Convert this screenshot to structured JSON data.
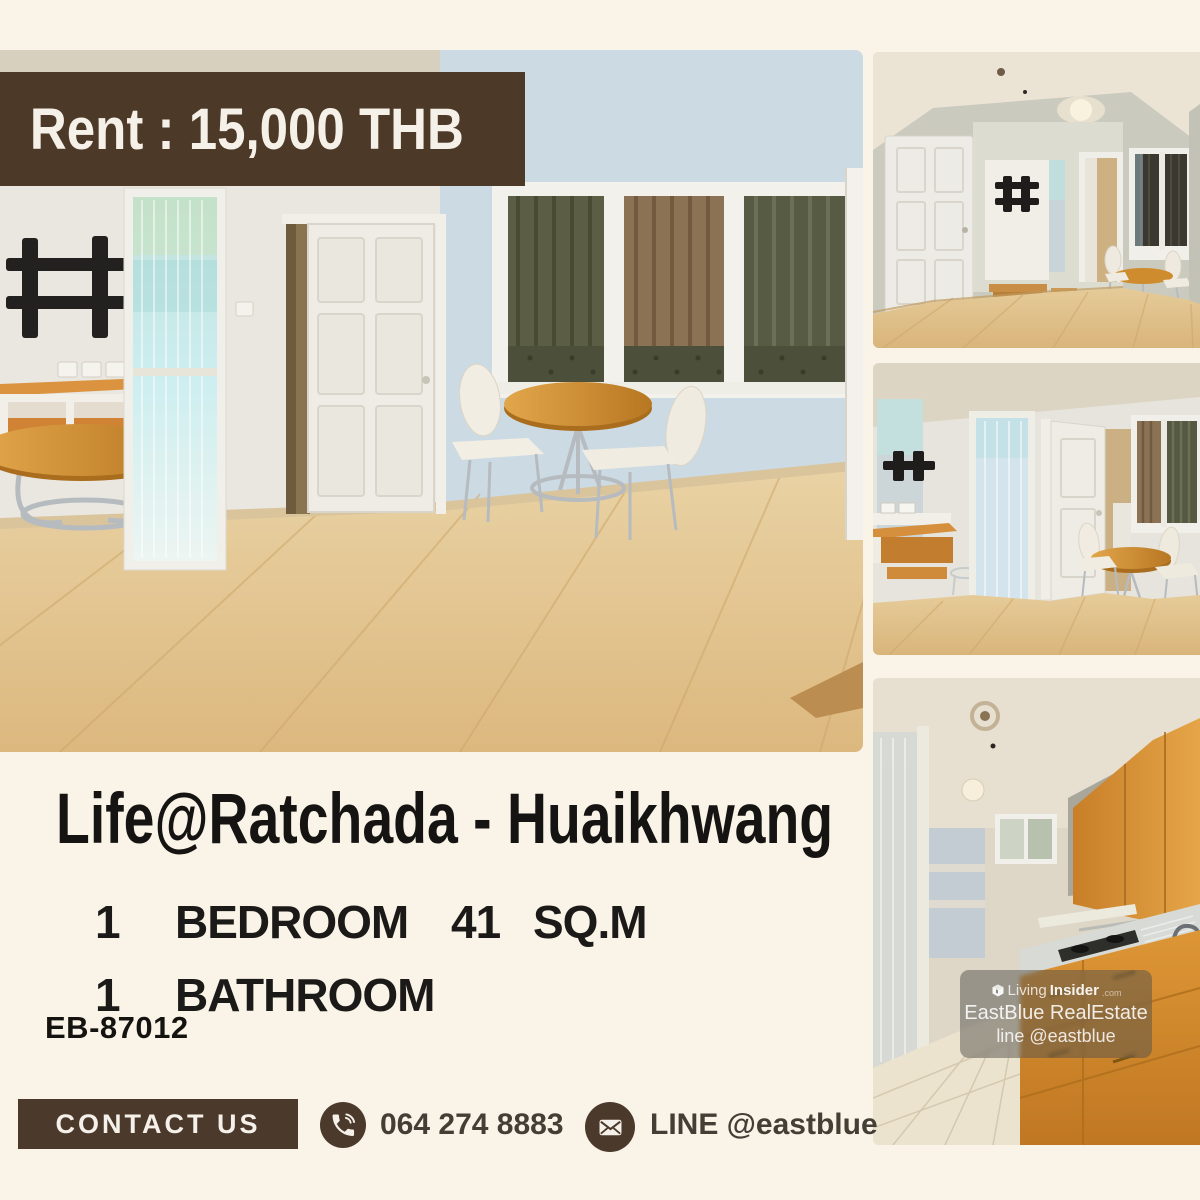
{
  "banner": {
    "label": "Rent : 15,000 THB"
  },
  "title": "Life@Ratchada - Huaikhwang",
  "specs": {
    "bedroom_count": "1",
    "bedroom_label": "BEDROOM",
    "area_value": "41",
    "area_unit": "SQ.M",
    "bathroom_count": "1",
    "bathroom_label": "BATHROOM"
  },
  "listing_code": "EB-87012",
  "contact_bar": {
    "button_label": "CONTACT US",
    "phone_number": "064 274 8883",
    "line_label": "LINE @eastblue"
  },
  "watermark": {
    "brand_part1": "Living",
    "brand_part2": "Insider",
    "brand_suffix": ".com",
    "agency": "EastBlue RealEstate",
    "line_account": "line @eastblue"
  },
  "colors": {
    "background": "#f9f4e7",
    "brand_brown": "#4b3a2b",
    "text_dark": "#1b1a18",
    "contact_text": "#443e36"
  },
  "icons": {
    "phone": "phone-icon",
    "envelope": "envelope-icon",
    "logo": "livinginsider-logo-icon"
  },
  "photos": {
    "main": "living room with TV wall mount, orange console, glass door, white door and dining set",
    "top_right": "wide angle living room with white door and curtained window",
    "mid_right": "living room dining corner with mirror, console and olive curtains",
    "bottom_right": "kitchen with orange cabinets, counter, sink and tiled floor"
  }
}
